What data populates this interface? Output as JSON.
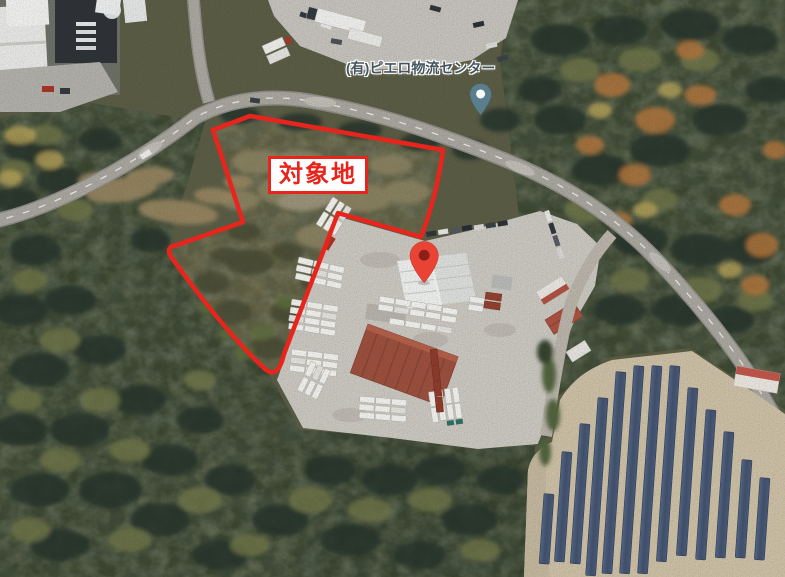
{
  "map": {
    "site_label": "対象地",
    "business_label": "(有)ピエロ物流センター",
    "colors": {
      "boundary": "#e8251d",
      "site_marker": "#e94335",
      "site_marker_dot": "#8c1f18",
      "place_pin": "#5b7e8c"
    }
  }
}
